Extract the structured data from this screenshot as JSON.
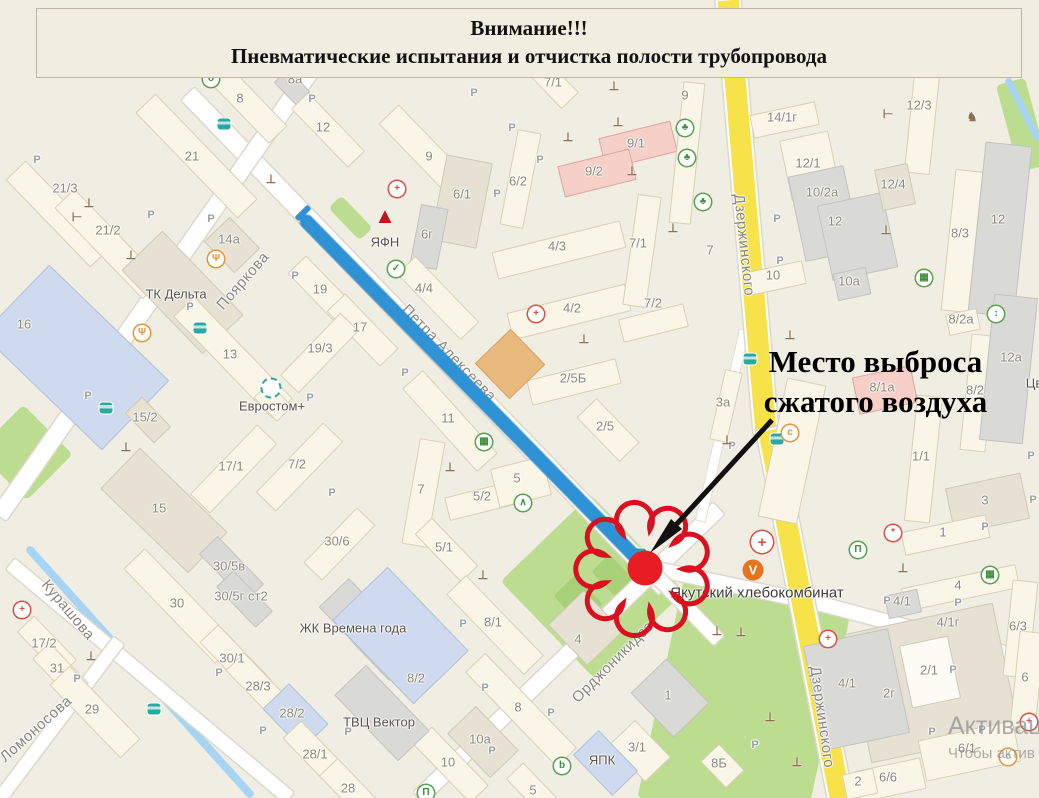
{
  "banner": {
    "line1": "Внимание!!!",
    "line2": "Пневматические испытания и отчистка полости трубопровода"
  },
  "callout": {
    "line1": "Место выброса",
    "line2": "сжатого воздуха"
  },
  "watermark": {
    "line1": "Активация",
    "line2": "Чтобы актив"
  },
  "colors": {
    "pipeline_blue": "#2e92d5",
    "cloud_red": "#d8101f",
    "dot_red": "#e61d23",
    "road_yellow": "#f8e24a",
    "park_green": "#bcdc90",
    "banner_bg": "#f1ede0"
  },
  "map": {
    "parking_char": "P",
    "street_labels": [
      {
        "t": "Пояркова",
        "x": 243,
        "y": 281,
        "r": -49
      },
      {
        "t": "Петра Алексеева",
        "x": 449,
        "y": 353,
        "r": 46
      },
      {
        "t": "Орджоникидзе",
        "x": 613,
        "y": 662,
        "r": -45
      },
      {
        "t": "Дзержинского",
        "x": 744,
        "y": 245,
        "r": 84
      },
      {
        "t": "Дзержинского",
        "x": 822,
        "y": 717,
        "r": 82
      },
      {
        "t": "Курашова",
        "x": 68,
        "y": 610,
        "r": 50
      },
      {
        "t": "Ломоносова",
        "x": 36,
        "y": 729,
        "r": -42
      }
    ],
    "poi_labels": [
      {
        "t": "ТК Дельта",
        "x": 176,
        "y": 294
      },
      {
        "t": "Евростом+",
        "x": 272,
        "y": 406
      },
      {
        "t": "ЖК Времена года",
        "x": 353,
        "y": 628
      },
      {
        "t": "ТВЦ Вектор",
        "x": 379,
        "y": 722
      },
      {
        "t": "ЯФН",
        "x": 385,
        "y": 242
      },
      {
        "t": "ЯПК",
        "x": 602,
        "y": 760
      },
      {
        "t": "Якутский хлебокомбинат",
        "x": 757,
        "y": 593,
        "big": true
      },
      {
        "t": "Цв",
        "x": 1034,
        "y": 383
      }
    ],
    "building_labels": [
      {
        "t": "8а",
        "x": 295,
        "y": 79
      },
      {
        "t": "8",
        "x": 240,
        "y": 98
      },
      {
        "t": "12",
        "x": 323,
        "y": 127
      },
      {
        "t": "21",
        "x": 192,
        "y": 156
      },
      {
        "t": "21/3",
        "x": 65,
        "y": 188
      },
      {
        "t": "21/2",
        "x": 108,
        "y": 230
      },
      {
        "t": "14а",
        "x": 229,
        "y": 239
      },
      {
        "t": "16",
        "x": 24,
        "y": 324
      },
      {
        "t": "19",
        "x": 320,
        "y": 289
      },
      {
        "t": "17",
        "x": 360,
        "y": 327
      },
      {
        "t": "19/3",
        "x": 320,
        "y": 348
      },
      {
        "t": "13",
        "x": 230,
        "y": 354
      },
      {
        "t": "15/2",
        "x": 145,
        "y": 417
      },
      {
        "t": "17/1",
        "x": 231,
        "y": 466
      },
      {
        "t": "7/2",
        "x": 297,
        "y": 464
      },
      {
        "t": "15",
        "x": 159,
        "y": 508
      },
      {
        "t": "30/6",
        "x": 337,
        "y": 541
      },
      {
        "t": "30/5в",
        "x": 229,
        "y": 566
      },
      {
        "t": "30",
        "x": 177,
        "y": 603
      },
      {
        "t": "30/5г ст2",
        "x": 241,
        "y": 596
      },
      {
        "t": "30/1",
        "x": 232,
        "y": 658
      },
      {
        "t": "28/3",
        "x": 258,
        "y": 686
      },
      {
        "t": "28/2",
        "x": 292,
        "y": 713
      },
      {
        "t": "28/1",
        "x": 315,
        "y": 754
      },
      {
        "t": "29",
        "x": 92,
        "y": 709
      },
      {
        "t": "31",
        "x": 57,
        "y": 668
      },
      {
        "t": "17/2",
        "x": 44,
        "y": 643
      },
      {
        "t": "28",
        "x": 348,
        "y": 788
      },
      {
        "t": "9",
        "x": 429,
        "y": 156
      },
      {
        "t": "6/2",
        "x": 518,
        "y": 181
      },
      {
        "t": "6/1",
        "x": 462,
        "y": 194
      },
      {
        "t": "6г",
        "x": 427,
        "y": 234
      },
      {
        "t": "4/4",
        "x": 424,
        "y": 288
      },
      {
        "t": "4/3",
        "x": 557,
        "y": 246
      },
      {
        "t": "4/2",
        "x": 572,
        "y": 308
      },
      {
        "t": "7/1",
        "x": 638,
        "y": 243
      },
      {
        "t": "7/2",
        "x": 653,
        "y": 303
      },
      {
        "t": "9/1",
        "x": 636,
        "y": 143
      },
      {
        "t": "9/2",
        "x": 594,
        "y": 171
      },
      {
        "t": "7/1",
        "x": 553,
        "y": 82
      },
      {
        "t": "9",
        "x": 685,
        "y": 95
      },
      {
        "t": "2/5Б",
        "x": 573,
        "y": 378
      },
      {
        "t": "2/5",
        "x": 605,
        "y": 426
      },
      {
        "t": "11",
        "x": 448,
        "y": 418
      },
      {
        "t": "7",
        "x": 421,
        "y": 489
      },
      {
        "t": "5/2",
        "x": 482,
        "y": 496
      },
      {
        "t": "5",
        "x": 517,
        "y": 478
      },
      {
        "t": "5/1",
        "x": 444,
        "y": 547
      },
      {
        "t": "8/1",
        "x": 493,
        "y": 622
      },
      {
        "t": "8",
        "x": 518,
        "y": 707
      },
      {
        "t": "10а",
        "x": 480,
        "y": 739
      },
      {
        "t": "10",
        "x": 448,
        "y": 762
      },
      {
        "t": "8/2",
        "x": 416,
        "y": 678
      },
      {
        "t": "4",
        "x": 578,
        "y": 639
      },
      {
        "t": "1",
        "x": 668,
        "y": 695
      },
      {
        "t": "3/1",
        "x": 637,
        "y": 747
      },
      {
        "t": "5",
        "x": 533,
        "y": 790
      },
      {
        "t": "14/1г",
        "x": 782,
        "y": 117
      },
      {
        "t": "12/1",
        "x": 808,
        "y": 163
      },
      {
        "t": "10/2а",
        "x": 822,
        "y": 192
      },
      {
        "t": "12",
        "x": 835,
        "y": 221
      },
      {
        "t": "12/3",
        "x": 919,
        "y": 105
      },
      {
        "t": "12/4",
        "x": 893,
        "y": 184
      },
      {
        "t": "8/3",
        "x": 960,
        "y": 233
      },
      {
        "t": "12",
        "x": 998,
        "y": 219
      },
      {
        "t": "10",
        "x": 773,
        "y": 275
      },
      {
        "t": "10а",
        "x": 849,
        "y": 281
      },
      {
        "t": "8/2а",
        "x": 961,
        "y": 319
      },
      {
        "t": "7",
        "x": 710,
        "y": 250
      },
      {
        "t": "3а",
        "x": 723,
        "y": 402
      },
      {
        "t": "8/1а",
        "x": 882,
        "y": 387
      },
      {
        "t": "8/2",
        "x": 975,
        "y": 390
      },
      {
        "t": "12а",
        "x": 1011,
        "y": 357
      },
      {
        "t": "1/1",
        "x": 921,
        "y": 456
      },
      {
        "t": "3",
        "x": 985,
        "y": 500
      },
      {
        "t": "1",
        "x": 943,
        "y": 532
      },
      {
        "t": "4",
        "x": 958,
        "y": 585
      },
      {
        "t": "4/1",
        "x": 902,
        "y": 601
      },
      {
        "t": "4/1г",
        "x": 948,
        "y": 622
      },
      {
        "t": "2/1",
        "x": 929,
        "y": 670
      },
      {
        "t": "2г",
        "x": 889,
        "y": 693
      },
      {
        "t": "4/1",
        "x": 847,
        "y": 683
      },
      {
        "t": "6/3",
        "x": 1018,
        "y": 626
      },
      {
        "t": "6",
        "x": 1025,
        "y": 677
      },
      {
        "t": "6/1",
        "x": 967,
        "y": 748
      },
      {
        "t": "6/6",
        "x": 888,
        "y": 777
      },
      {
        "t": "2",
        "x": 858,
        "y": 781
      },
      {
        "t": "8Б",
        "x": 719,
        "y": 763
      }
    ],
    "parking_labels": [
      {
        "x": 312,
        "y": 99
      },
      {
        "x": 37,
        "y": 160
      },
      {
        "x": 151,
        "y": 215
      },
      {
        "x": 211,
        "y": 219
      },
      {
        "x": 190,
        "y": 307
      },
      {
        "x": 295,
        "y": 276
      },
      {
        "x": 88,
        "y": 396
      },
      {
        "x": 310,
        "y": 398
      },
      {
        "x": 332,
        "y": 493
      },
      {
        "x": 474,
        "y": 93
      },
      {
        "x": 512,
        "y": 128
      },
      {
        "x": 540,
        "y": 160
      },
      {
        "x": 497,
        "y": 194
      },
      {
        "x": 405,
        "y": 373
      },
      {
        "x": 777,
        "y": 219
      },
      {
        "x": 780,
        "y": 261
      },
      {
        "x": 1031,
        "y": 456
      },
      {
        "x": 1033,
        "y": 500
      },
      {
        "x": 985,
        "y": 527
      },
      {
        "x": 77,
        "y": 679
      },
      {
        "x": 219,
        "y": 673
      },
      {
        "x": 263,
        "y": 731
      },
      {
        "x": 348,
        "y": 732
      },
      {
        "x": 463,
        "y": 624
      },
      {
        "x": 485,
        "y": 688
      },
      {
        "x": 492,
        "y": 751
      },
      {
        "x": 551,
        "y": 713
      },
      {
        "x": 887,
        "y": 601
      },
      {
        "x": 958,
        "y": 603
      },
      {
        "x": 953,
        "y": 670
      },
      {
        "x": 932,
        "y": 732
      },
      {
        "x": 982,
        "y": 730
      },
      {
        "x": 755,
        "y": 745
      },
      {
        "x": 732,
        "y": 446
      }
    ],
    "icons": [
      {
        "type": "bus-stop",
        "x": 224,
        "y": 124
      },
      {
        "type": "bus-stop",
        "x": 200,
        "y": 328
      },
      {
        "type": "bus-stop",
        "x": 106,
        "y": 408
      },
      {
        "type": "bus-stop",
        "x": 154,
        "y": 709
      },
      {
        "type": "bus-stop",
        "x": 640,
        "y": 554
      },
      {
        "type": "bus-stop",
        "x": 750,
        "y": 359
      },
      {
        "type": "bus-stop",
        "x": 777,
        "y": 439
      },
      {
        "type": "pharmacy",
        "x": 397,
        "y": 189
      },
      {
        "type": "pharmacy",
        "x": 22,
        "y": 610
      },
      {
        "type": "pharmacy",
        "x": 536,
        "y": 314
      },
      {
        "type": "pharmacy",
        "x": 828,
        "y": 639
      },
      {
        "type": "pharmacy",
        "x": 1029,
        "y": 722
      },
      {
        "type": "medical-cross",
        "x": 762,
        "y": 542
      },
      {
        "type": "restaurant",
        "x": 216,
        "y": 259
      },
      {
        "type": "restaurant",
        "x": 142,
        "y": 333
      },
      {
        "type": "cart",
        "x": 484,
        "y": 442
      },
      {
        "type": "cart",
        "x": 924,
        "y": 278
      },
      {
        "type": "cart",
        "x": 990,
        "y": 575
      },
      {
        "type": "shoe-shop",
        "x": 396,
        "y": 269
      },
      {
        "type": "bell",
        "x": 685,
        "y": 128
      },
      {
        "type": "bell",
        "x": 687,
        "y": 158
      },
      {
        "type": "bell",
        "x": 703,
        "y": 202
      },
      {
        "type": "museum",
        "x": 426,
        "y": 793
      },
      {
        "type": "museum",
        "x": 858,
        "y": 550
      },
      {
        "type": "bottle",
        "x": 562,
        "y": 766
      },
      {
        "type": "thermometer",
        "x": 996,
        "y": 314
      },
      {
        "type": "dog-park",
        "x": 972,
        "y": 117
      },
      {
        "type": "coffee",
        "x": 790,
        "y": 433
      },
      {
        "type": "coffee",
        "x": 1008,
        "y": 757
      },
      {
        "type": "flower-shop",
        "x": 893,
        "y": 533
      },
      {
        "type": "education",
        "x": 523,
        "y": 503
      },
      {
        "type": "spring",
        "x": 211,
        "y": 79
      },
      {
        "type": "eurostom-logo",
        "x": 271,
        "y": 388
      },
      {
        "type": "bakery-logo",
        "x": 753,
        "y": 570
      },
      {
        "type": "yafn-logo",
        "x": 385,
        "y": 216
      },
      {
        "type": "dumbbell",
        "x": 77,
        "y": 217
      },
      {
        "type": "dumbbell",
        "x": 888,
        "y": 114
      },
      {
        "type": "playground",
        "x": 89,
        "y": 203
      },
      {
        "type": "playground",
        "x": 271,
        "y": 179
      },
      {
        "type": "playground",
        "x": 131,
        "y": 255
      },
      {
        "type": "playground",
        "x": 614,
        "y": 86
      },
      {
        "type": "playground",
        "x": 618,
        "y": 122
      },
      {
        "type": "playground",
        "x": 568,
        "y": 137
      },
      {
        "type": "playground",
        "x": 632,
        "y": 171
      },
      {
        "type": "playground",
        "x": 673,
        "y": 228
      },
      {
        "type": "playground",
        "x": 584,
        "y": 339
      },
      {
        "type": "playground",
        "x": 450,
        "y": 467
      },
      {
        "type": "playground",
        "x": 886,
        "y": 230
      },
      {
        "type": "playground",
        "x": 903,
        "y": 568
      },
      {
        "type": "playground",
        "x": 727,
        "y": 440
      },
      {
        "type": "playground",
        "x": 790,
        "y": 335
      },
      {
        "type": "playground",
        "x": 483,
        "y": 575
      },
      {
        "type": "playground",
        "x": 91,
        "y": 656
      },
      {
        "type": "playground",
        "x": 126,
        "y": 447
      },
      {
        "type": "playground",
        "x": 717,
        "y": 631
      },
      {
        "type": "playground",
        "x": 741,
        "y": 632
      },
      {
        "type": "playground",
        "x": 770,
        "y": 717
      },
      {
        "type": "playground",
        "x": 797,
        "y": 762
      }
    ]
  }
}
